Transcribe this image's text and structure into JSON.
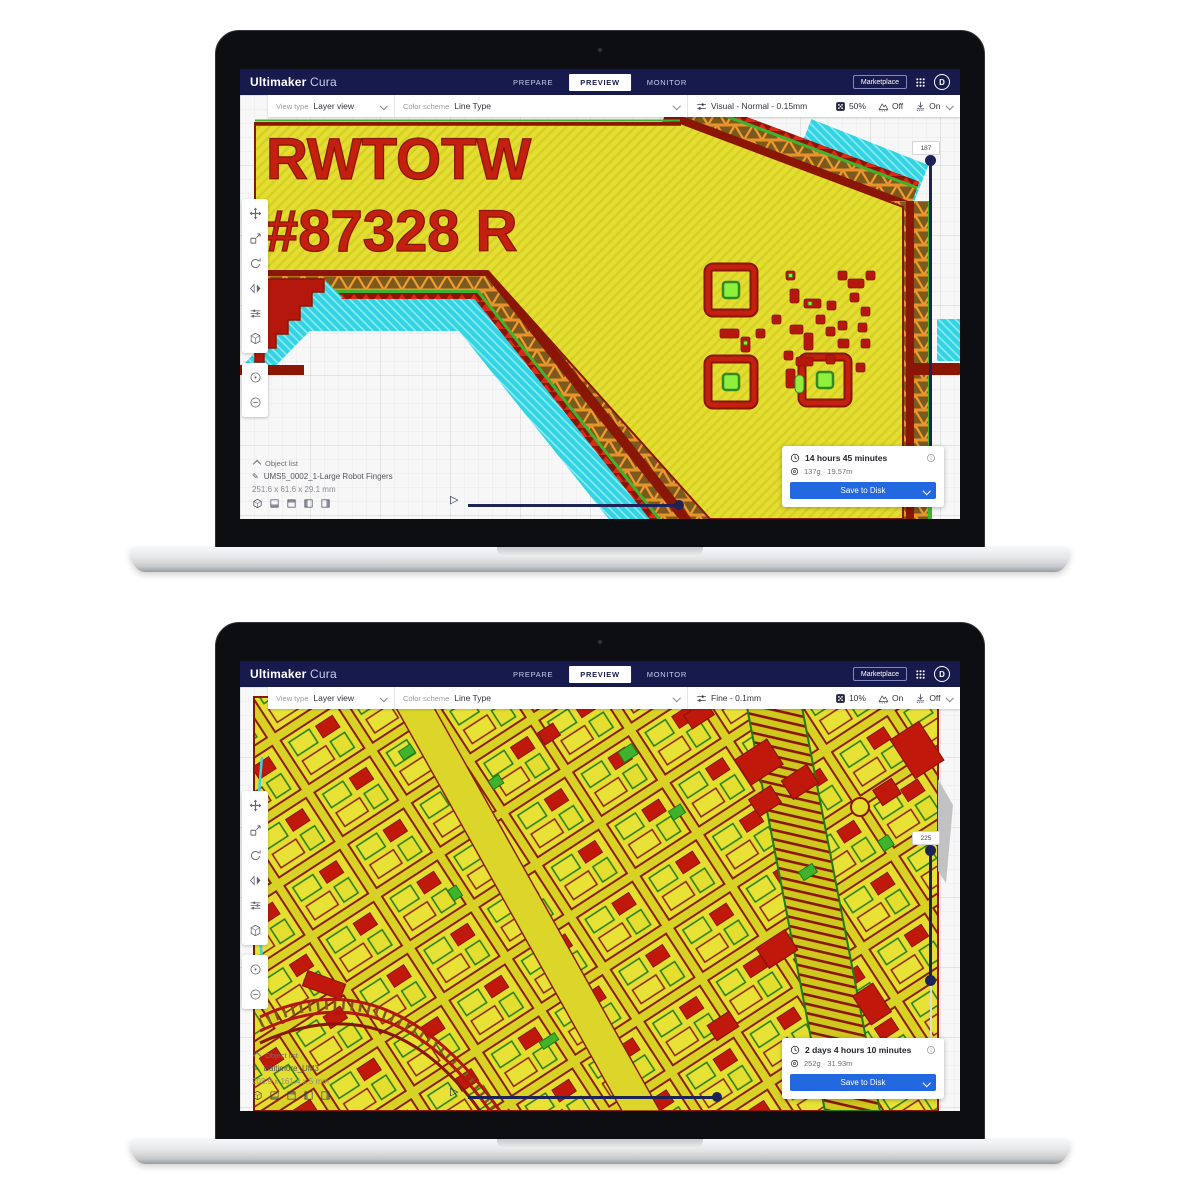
{
  "colors": {
    "header_navy": "#171a4d",
    "accent_blue": "#2268e0",
    "slider_navy": "#1d2257",
    "model_yellow": "#e4de30",
    "model_red": "#c4200f",
    "model_dark_red": "#8a1606",
    "model_green": "#3fb32c",
    "model_bright_green": "#8fef3d",
    "model_cyan": "#32d3e2",
    "model_orange": "#f09b2e"
  },
  "app": {
    "brand_bold": "Ultimaker",
    "brand_light": "Cura",
    "tabs": [
      "PREPARE",
      "PREVIEW",
      "MONITOR"
    ],
    "active_tab": "PREVIEW",
    "marketplace_label": "Marketplace",
    "avatar_letter": "D"
  },
  "icons": {
    "play_glyph": "▷",
    "pencil_glyph": "✎"
  },
  "laptops": [
    {
      "view_bar": {
        "view_type_label": "View type",
        "view_type_value": "Layer view",
        "color_scheme_label": "Color scheme",
        "color_scheme_value": "Line Type",
        "profile": "Visual - Normal - 0.15mm",
        "infill_percent": "50%",
        "support_state": "Off",
        "adhesion_state": "On"
      },
      "layer_slider_value": "187",
      "model_text_line1": "RWTOTW",
      "model_text_line2": "#87328 R",
      "object_list": {
        "title": "Object list",
        "item_name": "UMS5_0002_1-Large Robot Fingers",
        "dimensions": "251.6 x 61.6 x 29.1 mm"
      },
      "print_summary": {
        "duration": "14 hours 45 minutes",
        "material": "137g · 19.57m",
        "save_button": "Save to Disk"
      }
    },
    {
      "view_bar": {
        "view_type_label": "View type",
        "view_type_value": "Layer view",
        "color_scheme_label": "Color scheme",
        "color_scheme_value": "Line Type",
        "profile": "Fine - 0.1mm",
        "infill_percent": "10%",
        "support_state": "On",
        "adhesion_state": "Off"
      },
      "layer_slider_value": "225",
      "object_list": {
        "title": "Object list",
        "item_name": "Baltimore_UM3",
        "dimensions": "203.9 x 161.4 x 5 mm"
      },
      "print_summary": {
        "duration": "2 days 4 hours 10 minutes",
        "material": "252g · 31.93m",
        "save_button": "Save to Disk"
      }
    }
  ]
}
